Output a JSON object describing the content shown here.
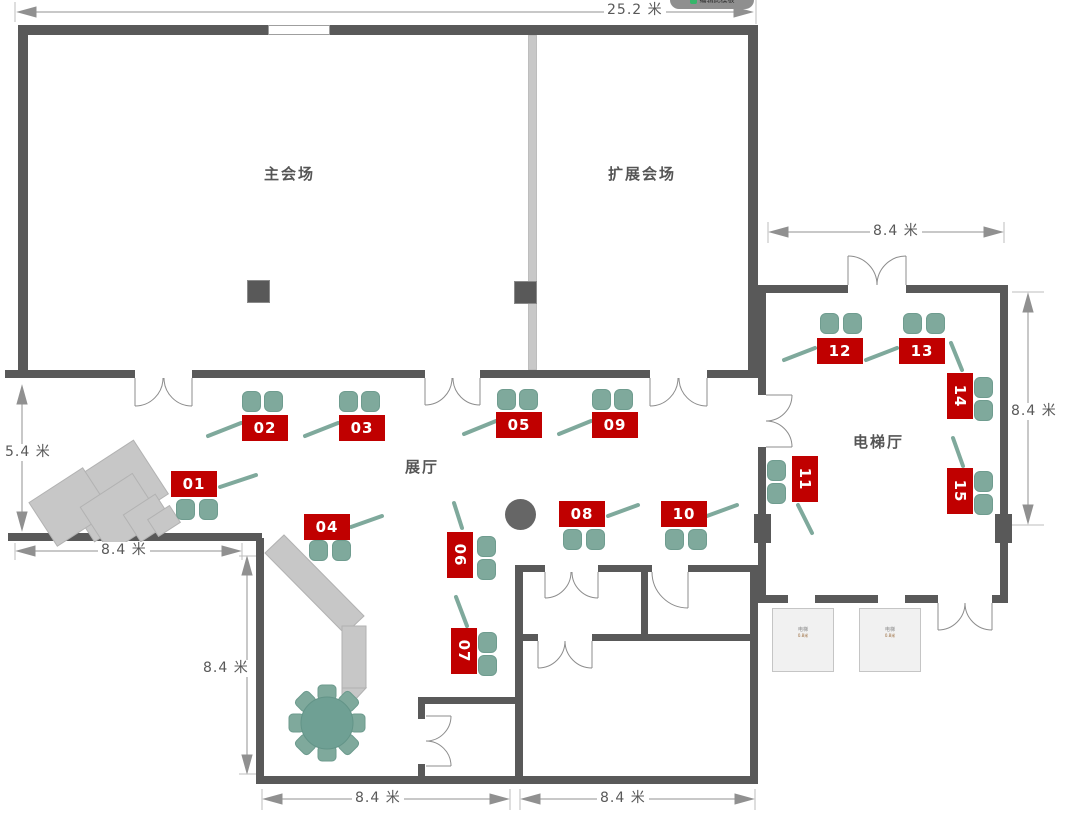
{
  "overlay_button": {
    "label": "编辑此模板"
  },
  "rooms": {
    "main_hall": "主会场",
    "extension_hall": "扩展会场",
    "exhibition_hall": "展厅",
    "elevator_hall": "电梯厅"
  },
  "dimensions": {
    "top_width": "25.2 米",
    "hall_height": "5.4 米",
    "stage_width": "8.4 米",
    "left_room_height": "8.4 米",
    "bottom_left_width": "8.4 米",
    "bottom_right_width": "8.4 米",
    "elevator_top_width": "8.4 米",
    "elevator_right_height": "8.4 米"
  },
  "booths": [
    {
      "id": "booth-01",
      "label": "01"
    },
    {
      "id": "booth-02",
      "label": "02"
    },
    {
      "id": "booth-03",
      "label": "03"
    },
    {
      "id": "booth-04",
      "label": "04"
    },
    {
      "id": "booth-05",
      "label": "05"
    },
    {
      "id": "booth-06",
      "label": "06"
    },
    {
      "id": "booth-07",
      "label": "07"
    },
    {
      "id": "booth-08",
      "label": "08"
    },
    {
      "id": "booth-09",
      "label": "09"
    },
    {
      "id": "booth-10",
      "label": "10"
    },
    {
      "id": "booth-11",
      "label": "11"
    },
    {
      "id": "booth-12",
      "label": "12"
    },
    {
      "id": "booth-13",
      "label": "13"
    },
    {
      "id": "booth-14",
      "label": "14"
    },
    {
      "id": "booth-15",
      "label": "15"
    }
  ],
  "elevators": [
    {
      "name": "电梯",
      "size": "0.8米"
    },
    {
      "name": "电梯",
      "size": "0.8米"
    }
  ],
  "colors": {
    "wall": "#595959",
    "booth_red": "#C00000",
    "furniture_teal": "#7FA99C",
    "table_teal": "#6FA094",
    "light_gray": "#C7C7C7",
    "dimension_gray": "#909090"
  }
}
